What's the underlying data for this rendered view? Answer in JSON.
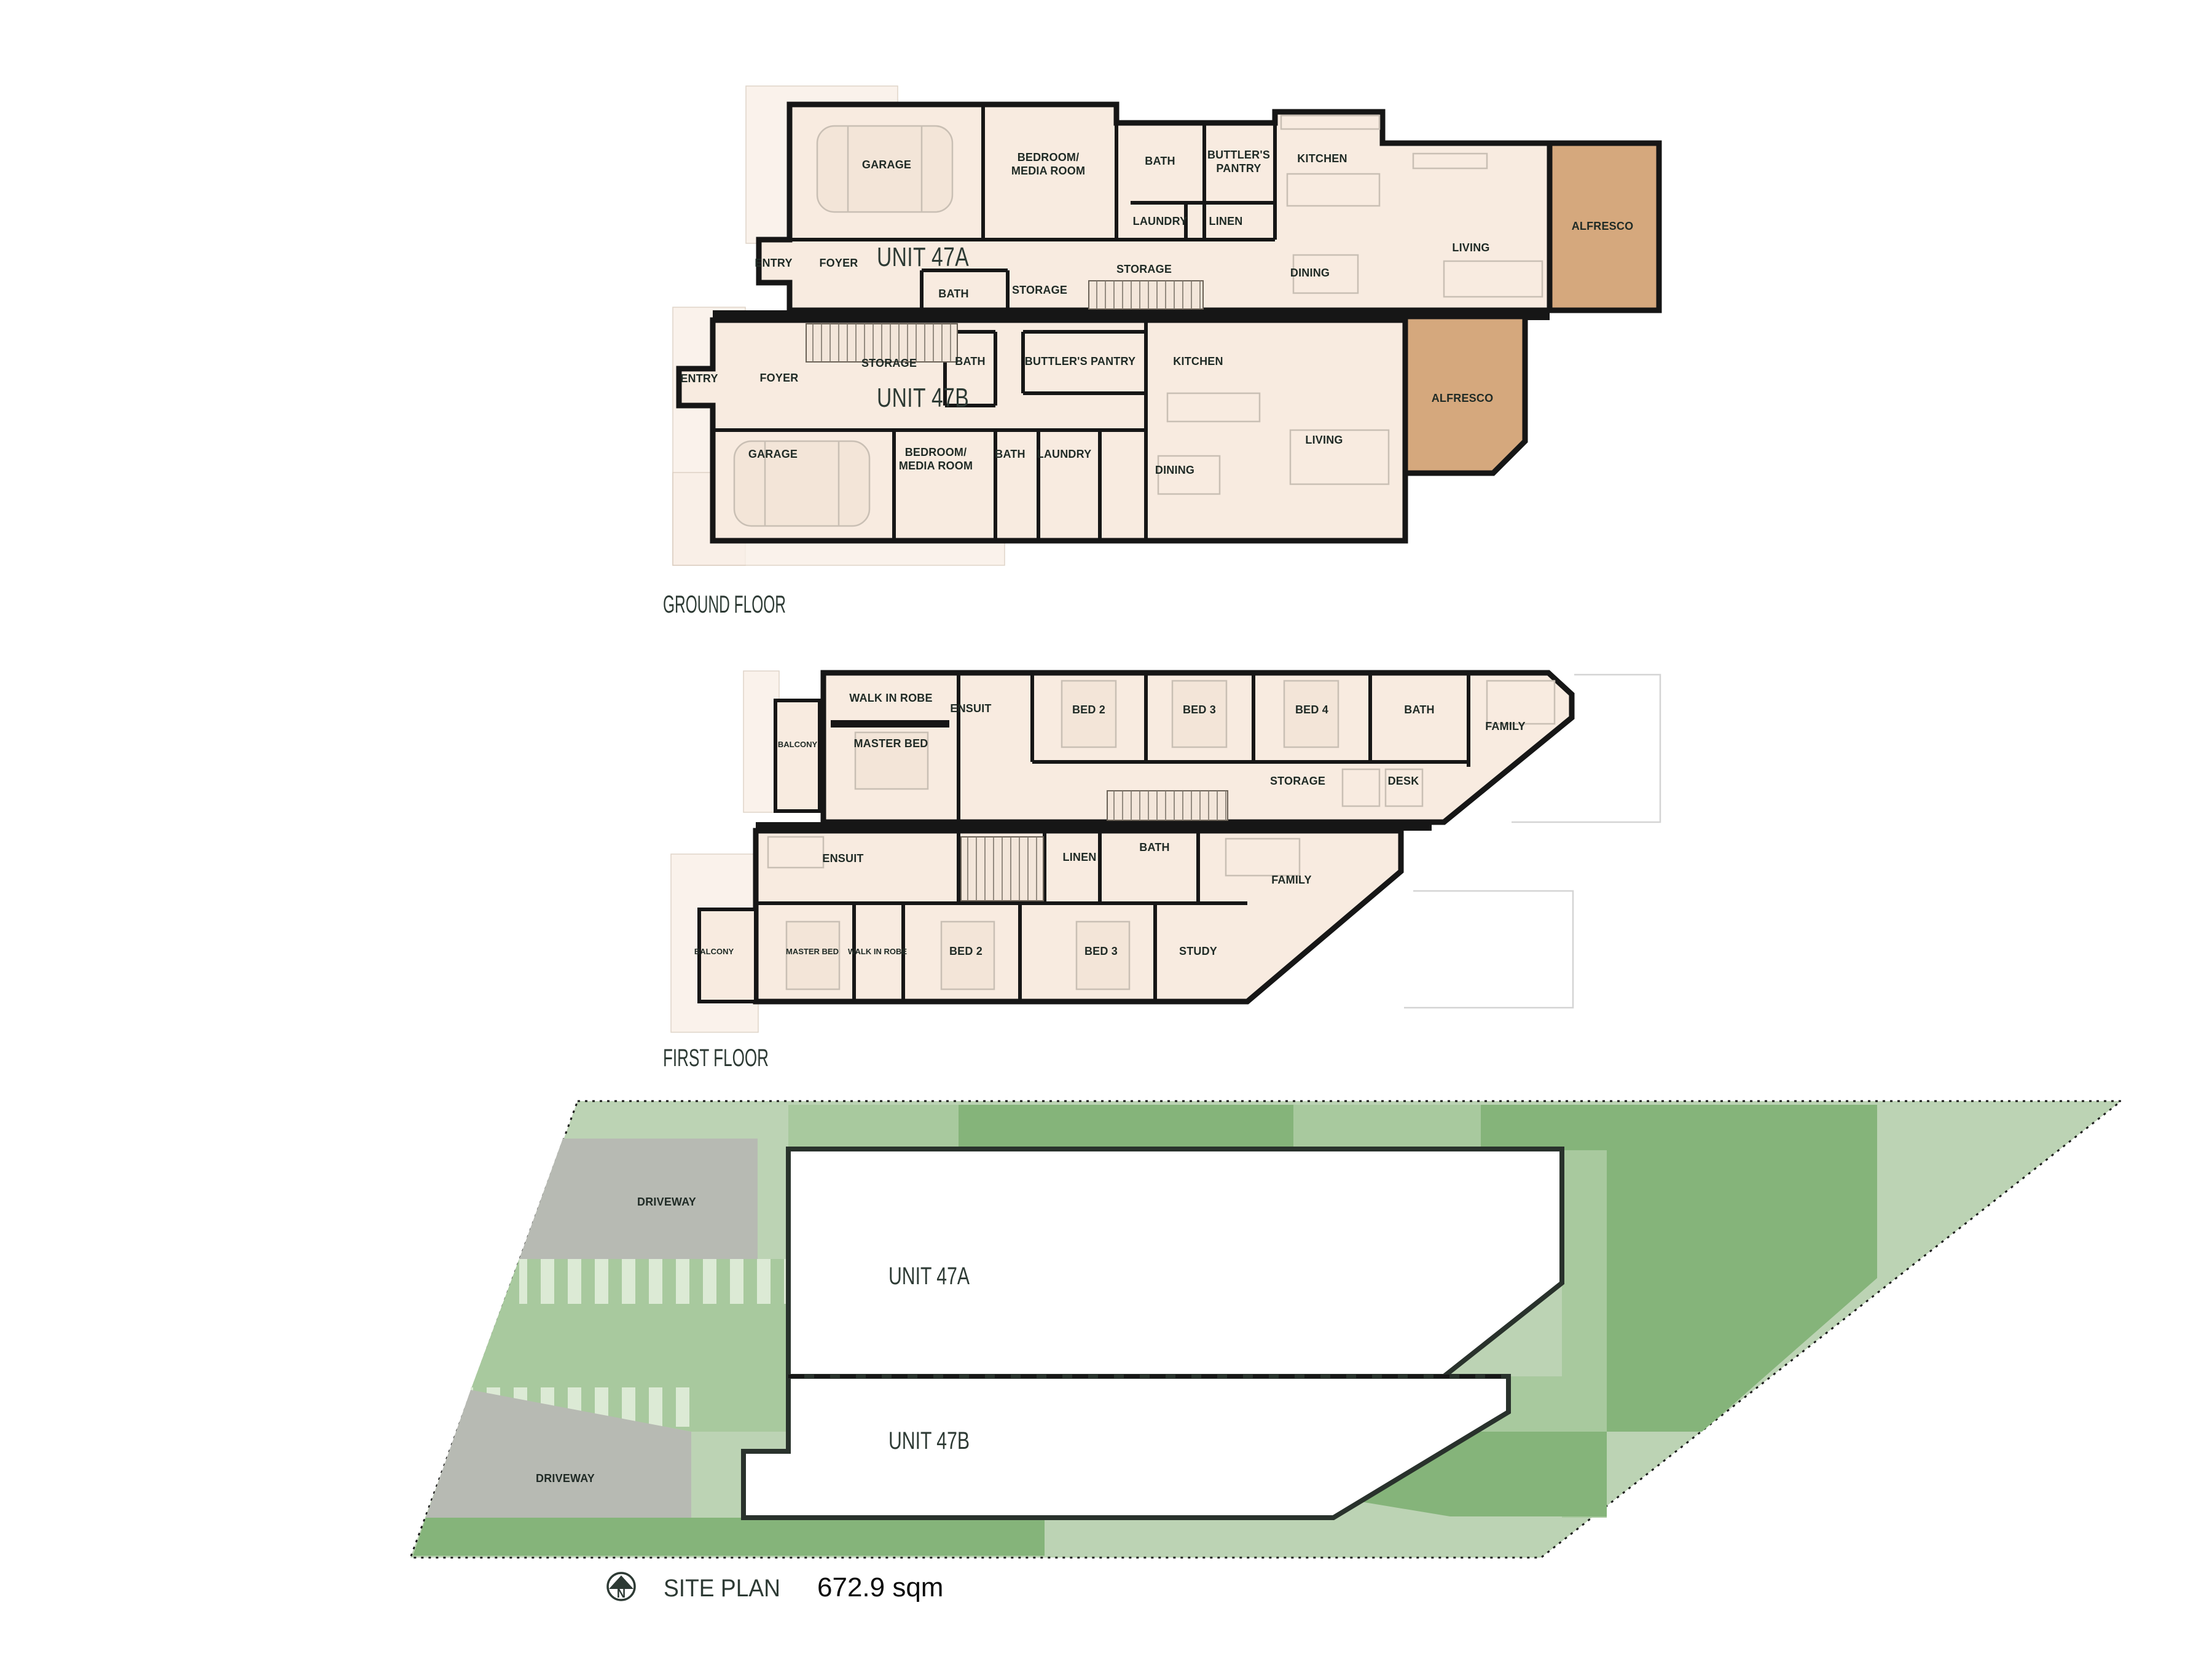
{
  "document": {
    "background": "#ffffff"
  },
  "palette": {
    "floor_fill": "#f8ebe0",
    "floor_fill_pale": "#f9efe7",
    "alfresco_fill": "#d5a87d",
    "wall_color": "#161616",
    "room_label_color": "#202b26",
    "title_color": "#2d3a34",
    "site_light_green": "#bcd3b4",
    "site_mid_green": "#a8c99e",
    "site_dark_green": "#85b47a",
    "driveway_gray": "#b7bab3",
    "building_white": "#ffffff"
  },
  "ground_floor": {
    "title": "GROUND FLOOR",
    "unit_a": {
      "name": "UNIT 47A",
      "garage": "GARAGE",
      "bedroom_media_l1": "BEDROOM/",
      "bedroom_media_l2": "MEDIA ROOM",
      "bath_top": "BATH",
      "butlers_l1": "BUTTLER'S",
      "butlers_l2": "PANTRY",
      "kitchen": "KITCHEN",
      "laundry": "LAUNDRY",
      "linen": "LINEN",
      "entry": "ENTRY",
      "foyer": "FOYER",
      "bath_mid": "BATH",
      "storage_mid": "STORAGE",
      "storage_top": "STORAGE",
      "dining": "DINING",
      "living": "LIVING",
      "alfresco": "ALFRESCO"
    },
    "unit_b": {
      "name": "UNIT 47B",
      "entry": "ENTRY",
      "foyer": "FOYER",
      "storage": "STORAGE",
      "bath_top": "BATH",
      "butlers": "BUTTLER'S PANTRY",
      "kitchen": "KITCHEN",
      "garage": "GARAGE",
      "bedroom_media_l1": "BEDROOM/",
      "bedroom_media_l2": "MEDIA ROOM",
      "bath": "BATH",
      "laundry": "LAUNDRY",
      "dining": "DINING",
      "living": "LIVING",
      "alfresco": "ALFRESCO"
    }
  },
  "first_floor": {
    "title": "FIRST FLOOR",
    "unit_a": {
      "balcony": "BALCONY",
      "walk_in_robe": "WALK IN ROBE",
      "master_bed": "MASTER BED",
      "ensuit": "ENSUIT",
      "bed2": "BED 2",
      "bed3": "BED 3",
      "bed4": "BED 4",
      "bath": "BATH",
      "family": "FAMILY",
      "storage": "STORAGE",
      "desk": "DESK"
    },
    "unit_b": {
      "ensuit": "ENSUIT",
      "linen": "LINEN",
      "bath": "BATH",
      "family": "FAMILY",
      "balcony": "BALCONY",
      "master_bed": "MASTER BED",
      "walk_in_robe": "WALK IN ROBE",
      "bed2": "BED 2",
      "bed3": "BED 3",
      "study": "STUDY"
    }
  },
  "site_plan": {
    "title": "SITE PLAN",
    "area": "672.9 sqm",
    "north_label": "N",
    "unit_a_label": "UNIT 47A",
    "unit_b_label": "UNIT 47B",
    "driveway_upper": "DRIVEWAY",
    "driveway_lower": "DRIVEWAY"
  }
}
